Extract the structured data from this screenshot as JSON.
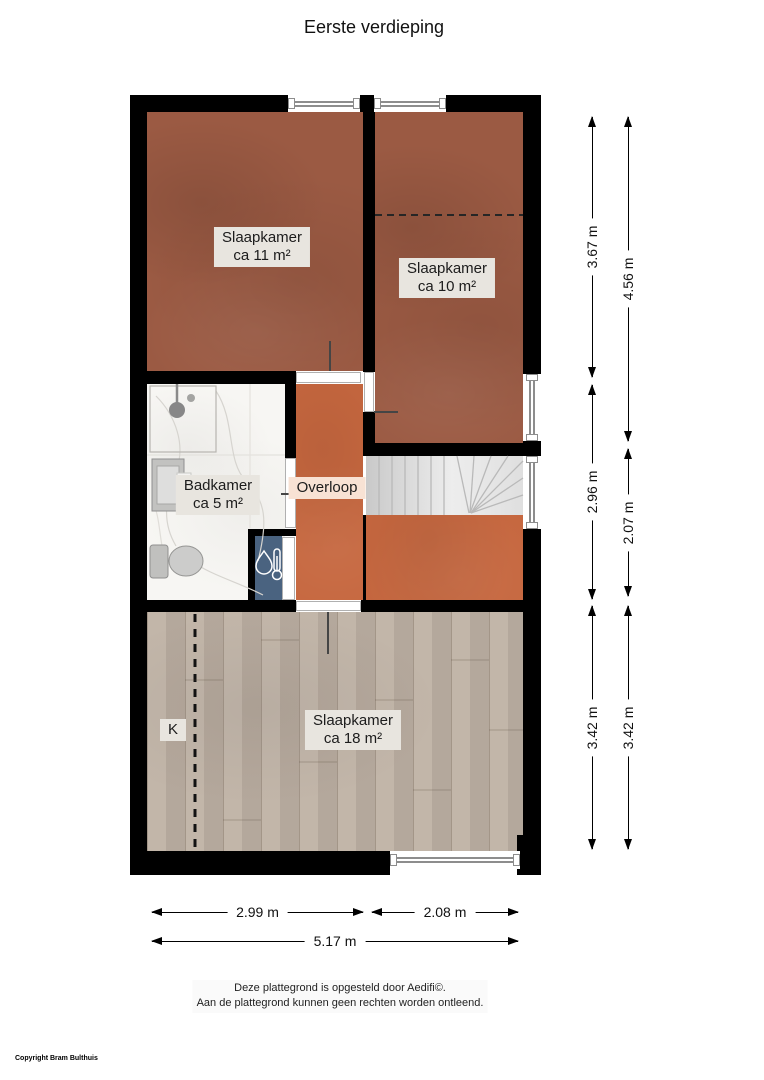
{
  "title": "Eerste verdieping",
  "rooms": {
    "slaapkamer_11": {
      "name": "Slaapkamer",
      "area": "ca 11 m²"
    },
    "slaapkamer_10": {
      "name": "Slaapkamer",
      "area": "ca 10 m²"
    },
    "badkamer": {
      "name": "Badkamer",
      "area": "ca 5 m²"
    },
    "overloop": {
      "name": "Overloop"
    },
    "slaapkamer_18": {
      "name": "Slaapkamer",
      "area": "ca 18 m²"
    },
    "closet": {
      "name": "K"
    }
  },
  "dimensions": {
    "vertical": [
      {
        "label": "3.67 m"
      },
      {
        "label": "4.56 m"
      },
      {
        "label": "2.96 m"
      },
      {
        "label": "2.07 m"
      },
      {
        "label": "3.42 m"
      },
      {
        "label": "3.42 m"
      }
    ],
    "horizontal": [
      {
        "label": "2.99 m"
      },
      {
        "label": "2.08 m"
      },
      {
        "label": "5.17 m"
      }
    ]
  },
  "icons": {
    "shower": "shower-head-icon",
    "sink": "sink-vanity-icon",
    "toilet": "toilet-icon",
    "boiler": "water-heater-icon",
    "stairs": "staircase-icon"
  },
  "footer": {
    "line1": "Deze plattegrond is opgesteld door Aedifi©.",
    "line2": "Aan de plattegrond kunnen geen rechten worden ontleend."
  },
  "copyright": "Copyright Bram Bulthuis",
  "colors": {
    "wall": "#000000",
    "bedroom_floor": "#9b5a43",
    "hall_floor": "#c6673f",
    "wood_floor": "#beb1a4",
    "closet_floor": "#4a6380",
    "bathroom_floor": "#f7f6f3",
    "label_bg": "#e8e5df",
    "hall_label_bg": "#f8e2d4"
  }
}
